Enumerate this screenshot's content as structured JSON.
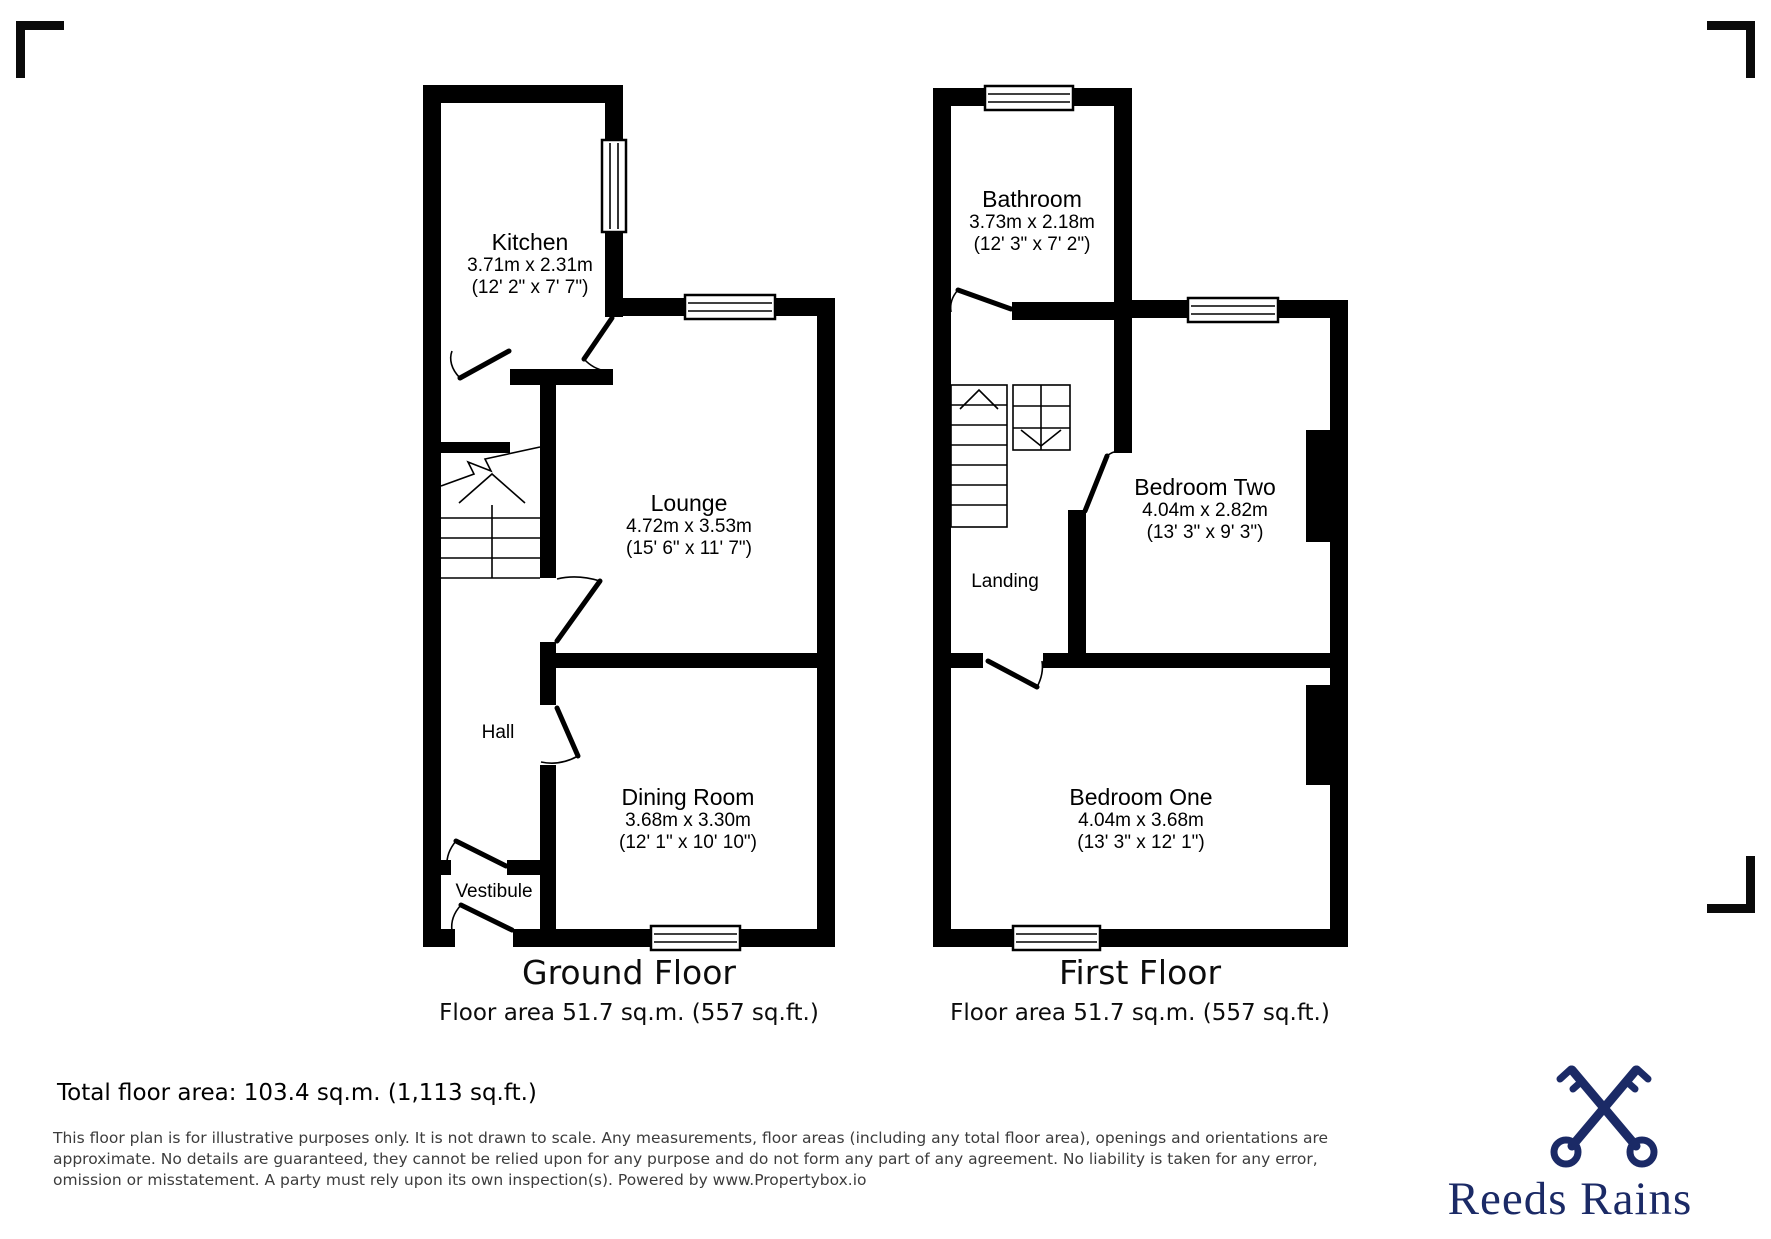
{
  "ground_floor": {
    "title": "Ground Floor",
    "area_label": "Floor area 51.7 sq.m. (557 sq.ft.)",
    "rooms": {
      "kitchen": {
        "name": "Kitchen",
        "metric": "3.71m x 2.31m",
        "imperial": "(12' 2\" x 7' 7\")"
      },
      "lounge": {
        "name": "Lounge",
        "metric": "4.72m x 3.53m",
        "imperial": "(15' 6\" x 11' 7\")"
      },
      "dining_room": {
        "name": "Dining Room",
        "metric": "3.68m x 3.30m",
        "imperial": "(12' 1\" x 10' 10\")"
      },
      "hall": {
        "name": "Hall"
      },
      "vestibule": {
        "name": "Vestibule"
      }
    }
  },
  "first_floor": {
    "title": "First Floor",
    "area_label": "Floor area 51.7 sq.m. (557 sq.ft.)",
    "rooms": {
      "bathroom": {
        "name": "Bathroom",
        "metric": "3.73m x 2.18m",
        "imperial": "(12' 3\" x 7' 2\")"
      },
      "bedroom_two": {
        "name": "Bedroom Two",
        "metric": "4.04m x 2.82m",
        "imperial": "(13' 3\" x 9' 3\")"
      },
      "bedroom_one": {
        "name": "Bedroom One",
        "metric": "4.04m x 3.68m",
        "imperial": "(13' 3\" x 12' 1\")"
      },
      "landing": {
        "name": "Landing"
      }
    }
  },
  "footer": {
    "total_area": "Total floor area: 103.4 sq.m. (1,113 sq.ft.)",
    "disclaimer": "This floor plan is for illustrative purposes only. It is not drawn to scale. Any measurements, floor areas (including any total floor area), openings and orientations are approximate. No details are guaranteed, they cannot be relied upon for any purpose and do not form any part of any agreement. No liability is taken for any error, omission or misstatement. A party must rely upon its own inspection(s). Powered by www.Propertybox.io"
  },
  "brand": {
    "name": "Reeds Rains",
    "color": "#1b2a66"
  }
}
